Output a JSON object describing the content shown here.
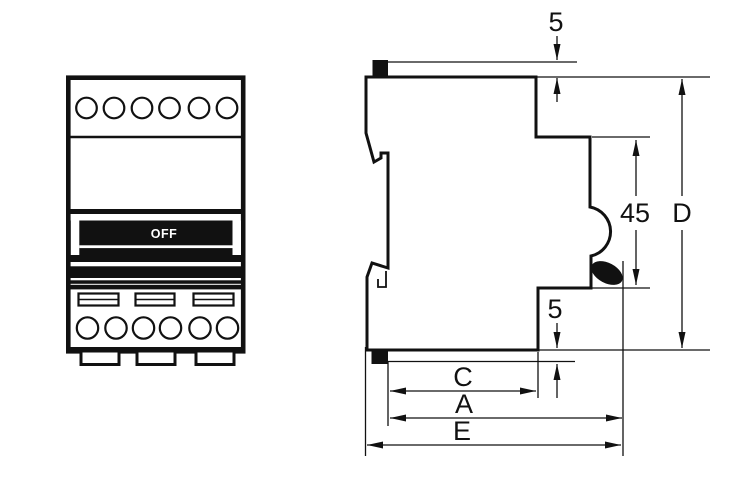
{
  "front_view": {
    "switch_label": "OFF"
  },
  "dimensions": {
    "top_clearance": "5",
    "bottom_clearance": "5",
    "recess_height": "45",
    "overall_height": "D",
    "width_c": "C",
    "width_a": "A",
    "width_e": "E"
  },
  "colors": {
    "line": "#111111",
    "background": "#ffffff"
  }
}
